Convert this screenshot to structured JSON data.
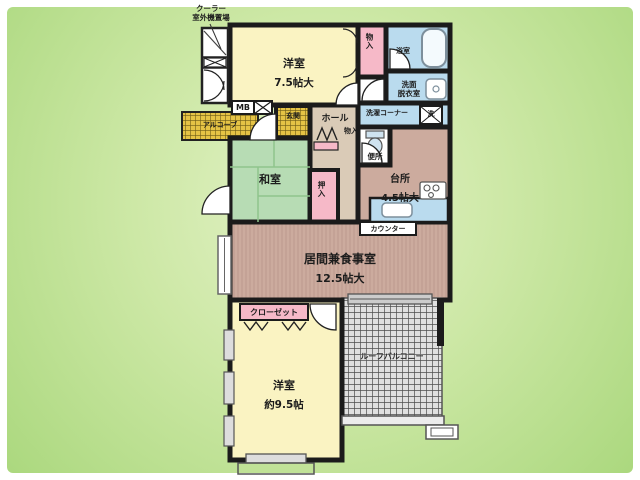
{
  "colors": {
    "background_green": "#c8e49f",
    "wall_black": "#1b1b1b",
    "room_yellow": "#faf3c2",
    "tatami_green": "#b7dcb4",
    "wood_brown": "#ccab9e",
    "hall_beige": "#dacbb7",
    "water_blue": "#badbee",
    "closet_pink": "#f6b9c8",
    "entrance_tile_yellow": "#e5c345",
    "balcony_tile_gray": "#e0e0e0"
  },
  "annotations": {
    "cooler_note": {
      "line1": "クーラー",
      "line2": "室外機置場"
    }
  },
  "rooms": {
    "bedroom1": {
      "name": "洋室",
      "size": "7.5帖大"
    },
    "storage_top": {
      "label": "物入"
    },
    "bath": {
      "label": "浴室"
    },
    "washroom": {
      "line1": "洗面",
      "line2": "脱衣室"
    },
    "laundry": {
      "label": "洗濯コーナー",
      "washer": "洗"
    },
    "meter_box": {
      "label": "MB"
    },
    "alcove": {
      "label": "アルコーブ"
    },
    "entrance": {
      "label": "玄関"
    },
    "hall": {
      "label": "ホール",
      "storage": "物入"
    },
    "toilet": {
      "label": "便所"
    },
    "kitchen": {
      "name": "台所",
      "size": "4.5帖大",
      "counter": "カウンター"
    },
    "japanese_room": {
      "label": "和室",
      "closet": "押入"
    },
    "living_dining": {
      "name": "居間兼食事室",
      "size": "12.5帖大"
    },
    "bedroom2": {
      "name": "洋室",
      "size": "約9.5帖",
      "closet": "クローゼット"
    },
    "balcony": {
      "label": "ルーフバルコニー"
    }
  }
}
